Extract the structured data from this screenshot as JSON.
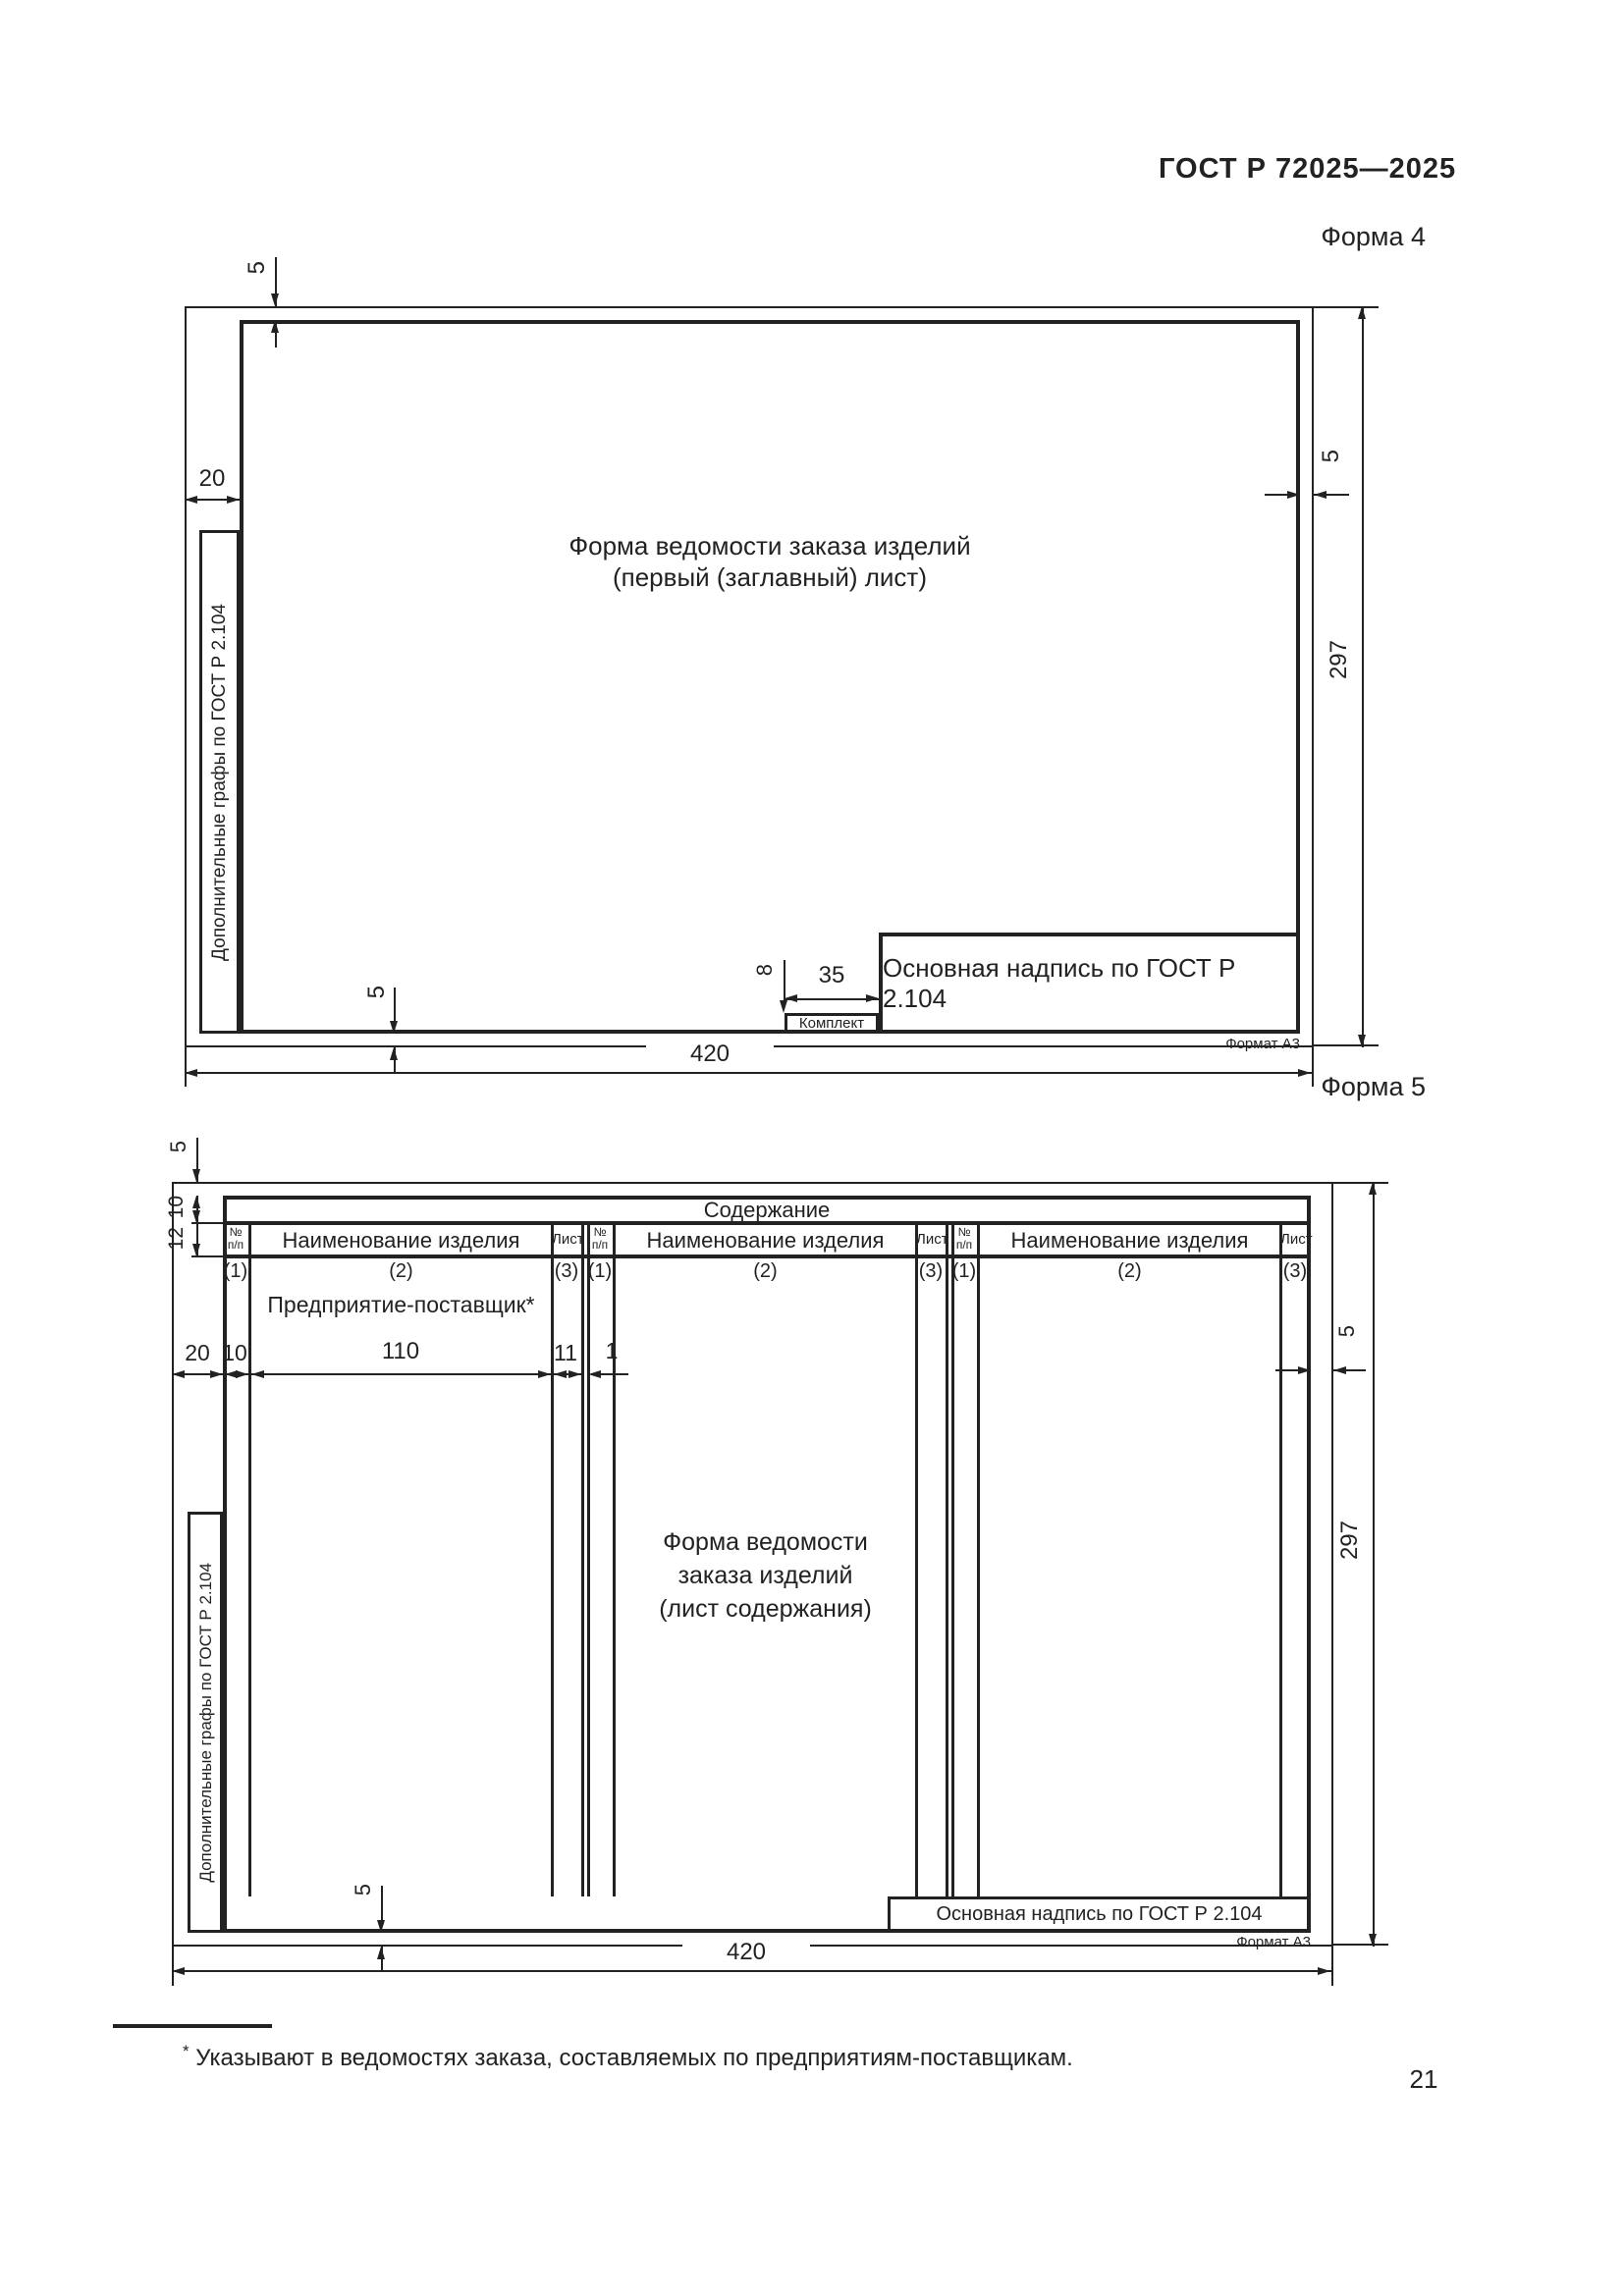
{
  "page": {
    "standard_code": "ГОСТ Р 72025—2025",
    "page_number": "21",
    "footnote_marker": "*",
    "footnote_text": "Указывают в ведомостях заказа, составляемых по предприятиям-поставщикам."
  },
  "form4": {
    "label": "Форма 4",
    "center_line1": "Форма ведомости заказа изделий",
    "center_line2": "(первый (заглавный) лист)",
    "margin_note": "Дополнительные графы по ГОСТ Р 2.104",
    "title_block": "Основная надпись по ГОСТ Р 2.104",
    "komplekt_label": "Комплект",
    "format_label": "Формат А3",
    "dims": {
      "top_margin": "5",
      "left_margin": "20",
      "right_margin": "5",
      "height": "297",
      "width": "420",
      "bottom_margin": "5",
      "komplekt_height": "8",
      "komplekt_width": "35"
    }
  },
  "form5": {
    "label": "Форма 5",
    "table": {
      "title": "Содержание",
      "sections": [
        {
          "num_top": "№",
          "num_bottom": "п/п",
          "name_header": "Наименование изделия",
          "sheet_header": "Лист",
          "ref_num": "(1)",
          "ref_name": "(2)",
          "ref_sheet": "(3)"
        },
        {
          "num_top": "№",
          "num_bottom": "п/п",
          "name_header": "Наименование изделия",
          "sheet_header": "Лист",
          "ref_num": "(1)",
          "ref_name": "(2)",
          "ref_sheet": "(3)"
        },
        {
          "num_top": "№",
          "num_bottom": "п/п",
          "name_header": "Наименование изделия",
          "sheet_header": "Лист",
          "ref_num": "(1)",
          "ref_name": "(2)",
          "ref_sheet": "(3)"
        }
      ]
    },
    "supplier_note": "Предприятие-поставщик*",
    "center_line1": "Форма ведомости",
    "center_line2": "заказа изделий",
    "center_line3": "(лист содержания)",
    "margin_note": "Дополнительные графы по ГОСТ Р 2.104",
    "title_block": "Основная надпись по ГОСТ Р 2.104",
    "format_label": "Формат А3",
    "dims": {
      "top_margin": "5",
      "row1_height": "10",
      "row2_height": "12",
      "left_margin": "20",
      "col_num": "10",
      "col_name": "110",
      "col_sheet": "11",
      "gap": "1",
      "right_margin": "5",
      "height": "297",
      "width": "420",
      "bottom_margin": "5"
    }
  }
}
